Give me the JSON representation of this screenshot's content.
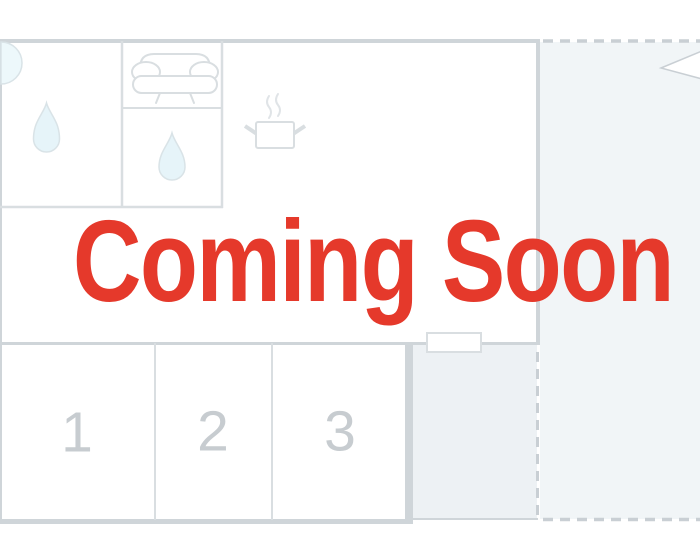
{
  "overlay": {
    "title": "Coming Soon"
  },
  "floorplan": {
    "rooms": [
      {
        "label": "1"
      },
      {
        "label": "2"
      },
      {
        "label": "3"
      }
    ],
    "icons": [
      {
        "name": "door-swing-icon"
      },
      {
        "name": "water-drop-icon"
      },
      {
        "name": "sofa-icon"
      },
      {
        "name": "water-drop-icon"
      },
      {
        "name": "cooking-pot-icon"
      },
      {
        "name": "window-icon"
      },
      {
        "name": "north-arrow-icon"
      }
    ]
  },
  "theme": {
    "accent_red": "#E5392B",
    "wall_gray": "#CFD5D9",
    "line_gray": "#D9DEE1",
    "dash_gray": "#C9CFD4",
    "number_gray": "#C7CCD0",
    "planned_area_fill": "#F1F5F7",
    "annex_fill": "#EDF1F4",
    "drop_fill": "#E6F4F9",
    "drop_stroke": "#D9E3E7",
    "arc_fill": "#EDF8FB",
    "steam_gray": "#E0E4E7",
    "canvas_white": "#FFFFFF"
  }
}
